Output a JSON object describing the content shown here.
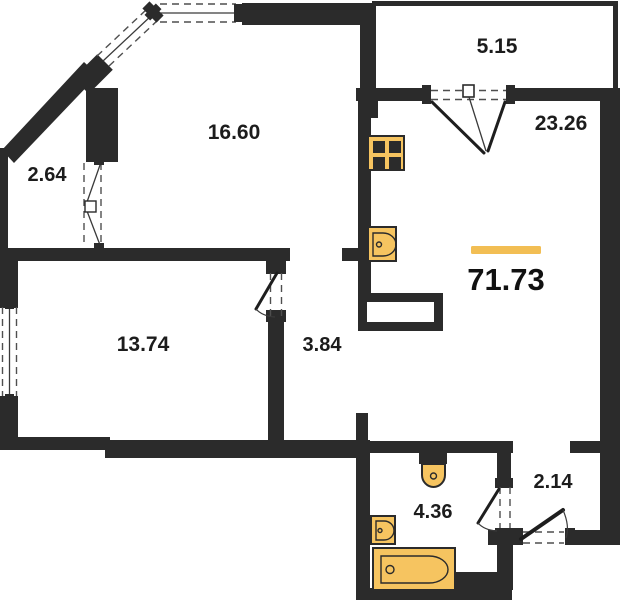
{
  "plan": {
    "type": "apartment-floor-plan",
    "total": {
      "area": "71.73"
    },
    "rooms": {
      "balcony_left": {
        "area": "2.64"
      },
      "living": {
        "area": "16.60"
      },
      "loggia_top": {
        "area": "5.15"
      },
      "kitchen_living": {
        "area": "23.26"
      },
      "bedroom": {
        "area": "13.74"
      },
      "corridor": {
        "area": "3.84"
      },
      "bathroom": {
        "area": "4.36"
      },
      "hallway": {
        "area": "2.14"
      }
    },
    "fixtures": {
      "stove": "stove-icon",
      "kitchen_sink": "kitchen-sink-icon",
      "toilet": "toilet-icon",
      "washbasin": "washbasin-icon",
      "bathtub": "bathtub-icon"
    },
    "colors": {
      "wall": "#2B2B2B",
      "fixture": "#F6C460",
      "accent_line": "#F2BE54",
      "dash": "#4F4F4F",
      "text": "#1C1C1C"
    }
  }
}
